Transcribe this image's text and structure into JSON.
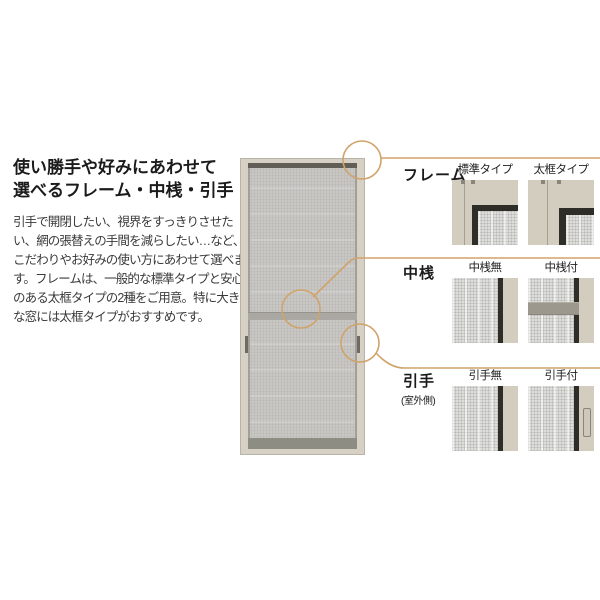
{
  "intro": {
    "heading_lines": [
      "使い勝手や好みにあわせて",
      "選べるフレーム・中桟・引手"
    ],
    "body_lines": [
      "引手で開閉したい、視界をすっきりさせた",
      "い、網の張替えの手間を減らしたい…など、",
      "こだわりやお好みの使い方にあわせて選べま",
      "す。フレームは、一般的な標準タイプと安心感",
      "のある太框タイプの2種をご用意。特に大き",
      "な窓には太框タイプがおすすめです。"
    ]
  },
  "sections": [
    {
      "label": "フレーム",
      "options": [
        {
          "caption": "標準タイプ"
        },
        {
          "caption": "太框タイプ"
        }
      ]
    },
    {
      "label": "中桟",
      "options": [
        {
          "caption": "中桟無"
        },
        {
          "caption": "中桟付"
        }
      ]
    },
    {
      "label": "引手",
      "sublabel": "(室外側)",
      "options": [
        {
          "caption": "引手無"
        },
        {
          "caption": "引手付"
        }
      ]
    }
  ],
  "colors": {
    "accent": "#d0a36a",
    "door_frame": "#d6d1c4",
    "mesh": "#c8c7c4",
    "dark_rail": "#2f2d28"
  }
}
